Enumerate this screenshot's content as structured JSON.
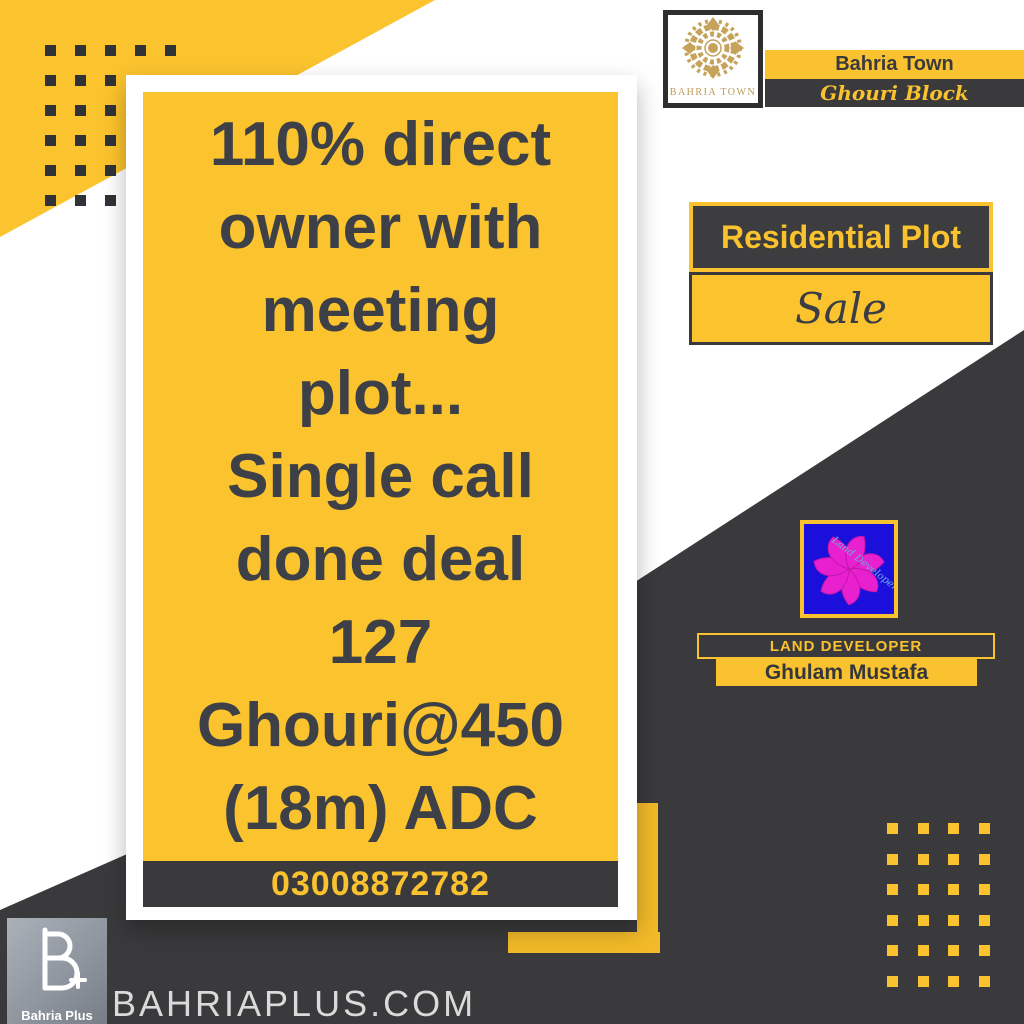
{
  "colors": {
    "accent_yellow": "#FBC32D",
    "dark_gray": "#3A3A3C",
    "text_dark": "#3D4147",
    "brand_gold": "#BD9B55",
    "developer_blue": "#1B10DB",
    "developer_pink": "#E820CF",
    "website_gray": "#DADADA"
  },
  "header": {
    "brand_logo_caption": "BAHRIA TOWN",
    "town_label": "Bahria Town",
    "block_label": "Ghouri Block"
  },
  "listing": {
    "type_label": "Residential Plot",
    "status_label": "Sale",
    "description_lines": [
      "110% direct",
      "owner with",
      "meeting",
      "plot...",
      "Single call",
      "done deal",
      "127",
      "Ghouri@450",
      "(18m) ADC"
    ],
    "phone": "03008872782"
  },
  "developer": {
    "logo_text": "Land Developer",
    "role_label": "LAND DEVELOPER",
    "name": "Ghulam Mustafa"
  },
  "footer": {
    "logo_label": "Bahria Plus",
    "website": "BAHRIAPLUS.COM"
  }
}
